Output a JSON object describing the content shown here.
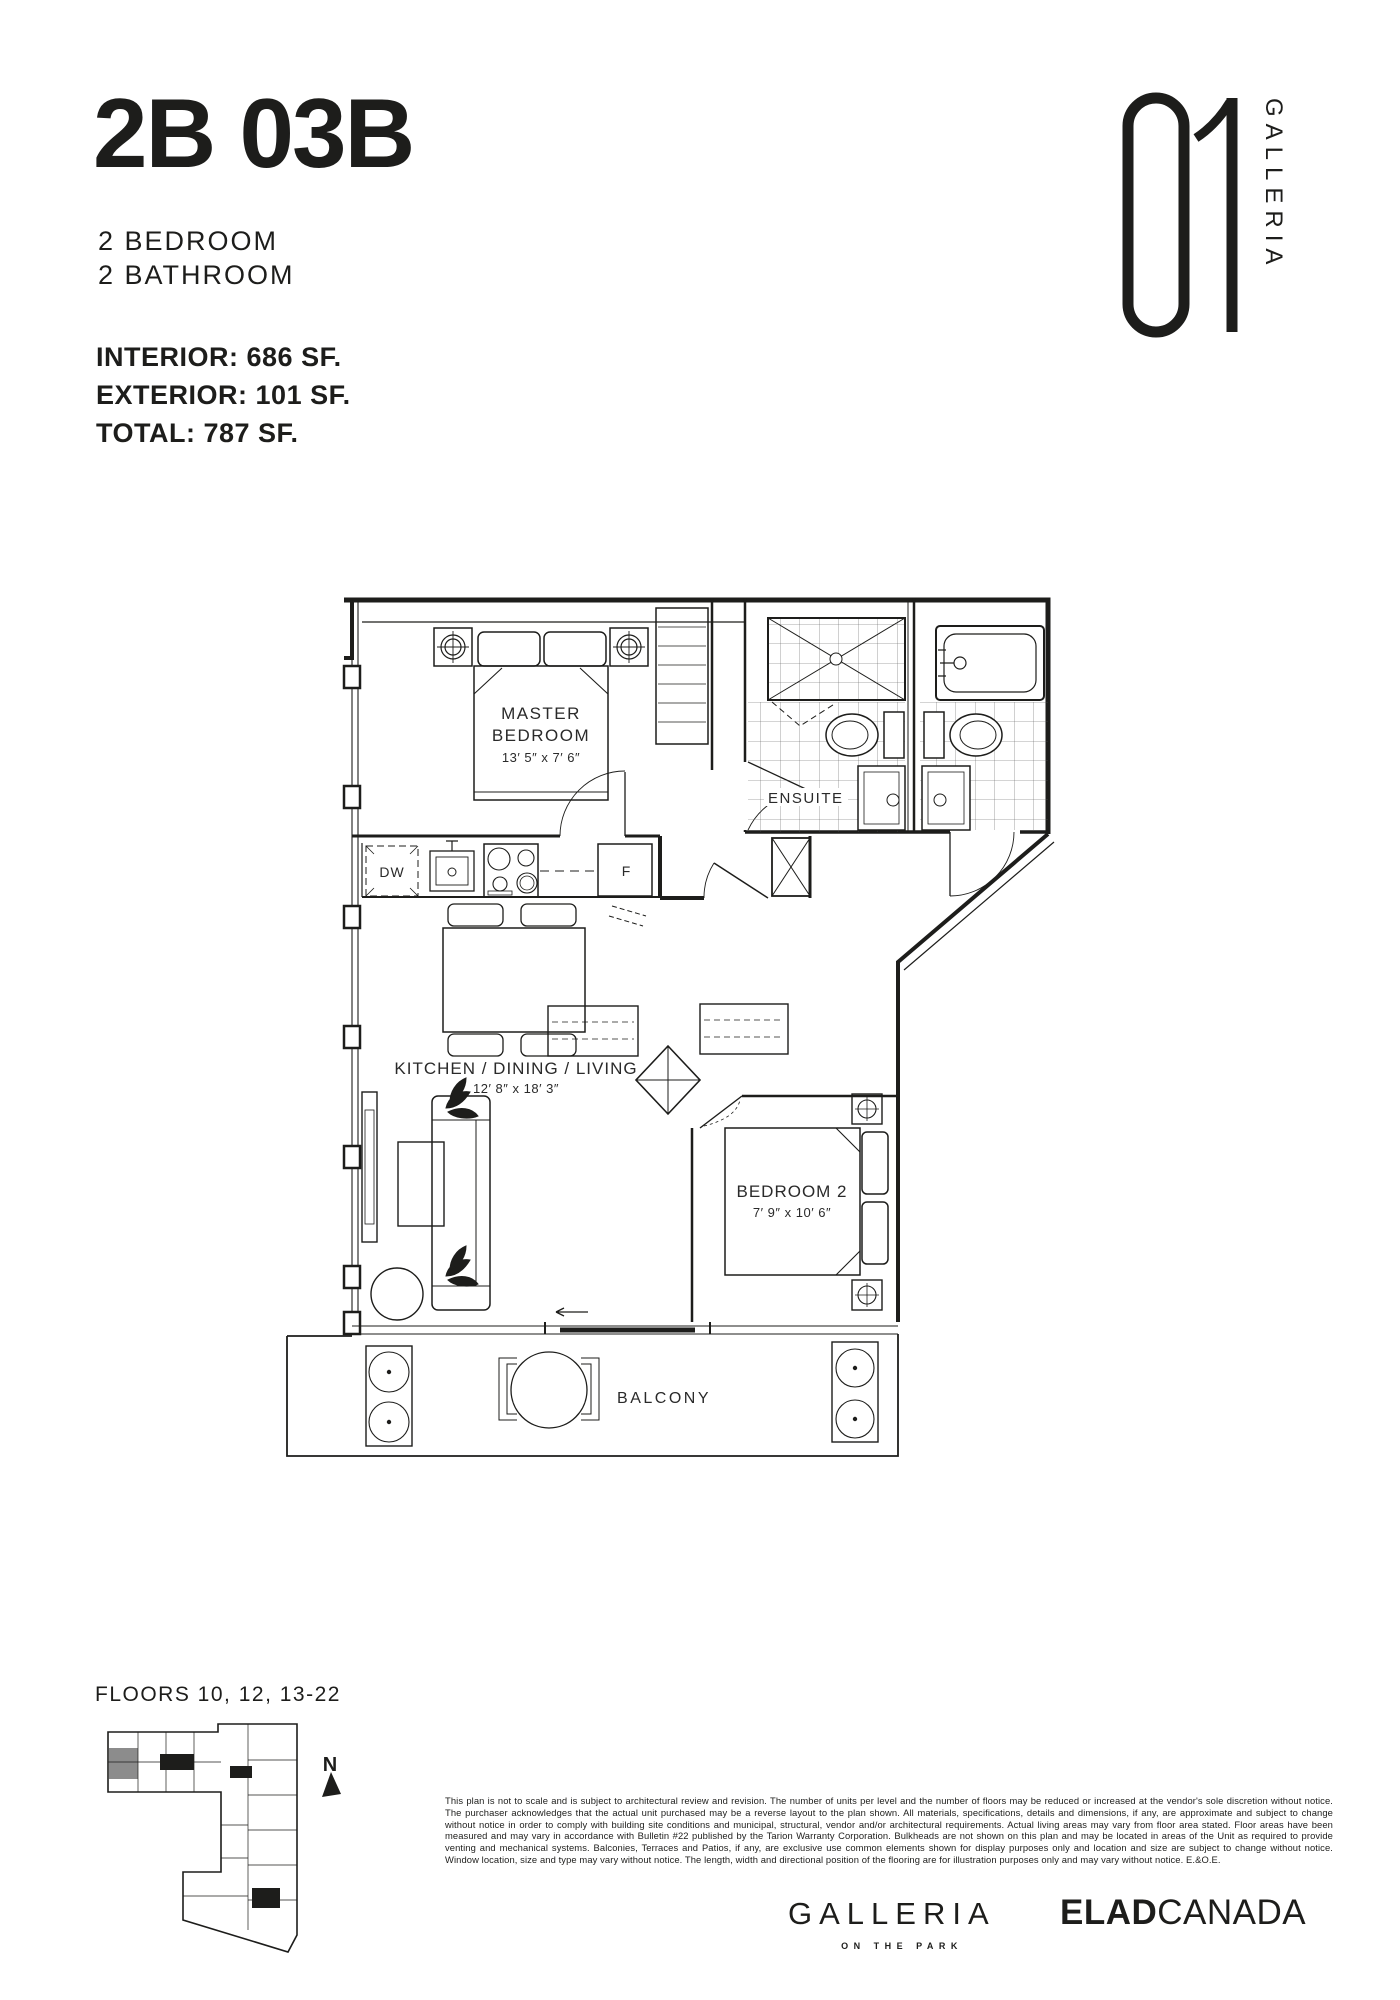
{
  "header": {
    "unit_code": "2B 03B",
    "type_lines": [
      "2 BEDROOM",
      "2 BATHROOM"
    ],
    "areas": [
      {
        "label": "INTERIOR:",
        "value": "686 SF."
      },
      {
        "label": "EXTERIOR:",
        "value": "101 SF."
      },
      {
        "label": "TOTAL:",
        "value": "787 SF."
      }
    ]
  },
  "logo": {
    "number": "01",
    "name": "GALLERIA"
  },
  "floorplan": {
    "master_bedroom": {
      "line1": "MASTER",
      "line2": "BEDROOM",
      "dims": "13′ 5″ x 7′ 6″"
    },
    "ensuite": {
      "label": "ENSUITE"
    },
    "kitchen": {
      "label": "KITCHEN / DINING / LIVING",
      "dims": "12′ 8″ x 18′ 3″",
      "dishwasher": "DW",
      "fridge": "F"
    },
    "bedroom2": {
      "label": "BEDROOM 2",
      "dims": "7′ 9″ x 10′ 6″"
    },
    "balcony": {
      "label": "BALCONY"
    }
  },
  "keyplan": {
    "floors": "FLOORS 10, 12, 13-22",
    "north": "N",
    "highlight_color": "#8c8c8c"
  },
  "disclaimer": "This plan is not to scale and is subject to architectural review and revision. The number of units per level and the number of floors may be reduced or increased at the vendor's sole discretion without notice. The purchaser acknowledges that the actual unit purchased may be a reverse layout to the plan shown. All materials, specifications, details and dimensions, if any, are approximate and subject to change without notice in order to comply with building site conditions and municipal, structural, vendor and/or architectural requirements. Actual living areas may vary from floor area stated. Floor areas have been measured and may vary in accordance with Bulletin #22 published by the Tarion Warranty Corporation. Bulkheads are not shown on this plan and may be located in areas of the Unit as required to provide venting and mechanical systems. Balconies, Terraces and Patios, if any, are exclusive use common elements shown for display purposes only and location and size are subject to change without notice. Window location, size and type may vary without notice. The length, width and directional position of the flooring are for illustration purposes only and may vary without notice. E.&O.E.",
  "footer": {
    "wordmark": "GALLERIA",
    "tagline": "ON THE PARK",
    "developer_bold": "ELAD",
    "developer_light": "CANADA"
  },
  "colors": {
    "ink": "#1d1d1b",
    "paper": "#ffffff"
  }
}
